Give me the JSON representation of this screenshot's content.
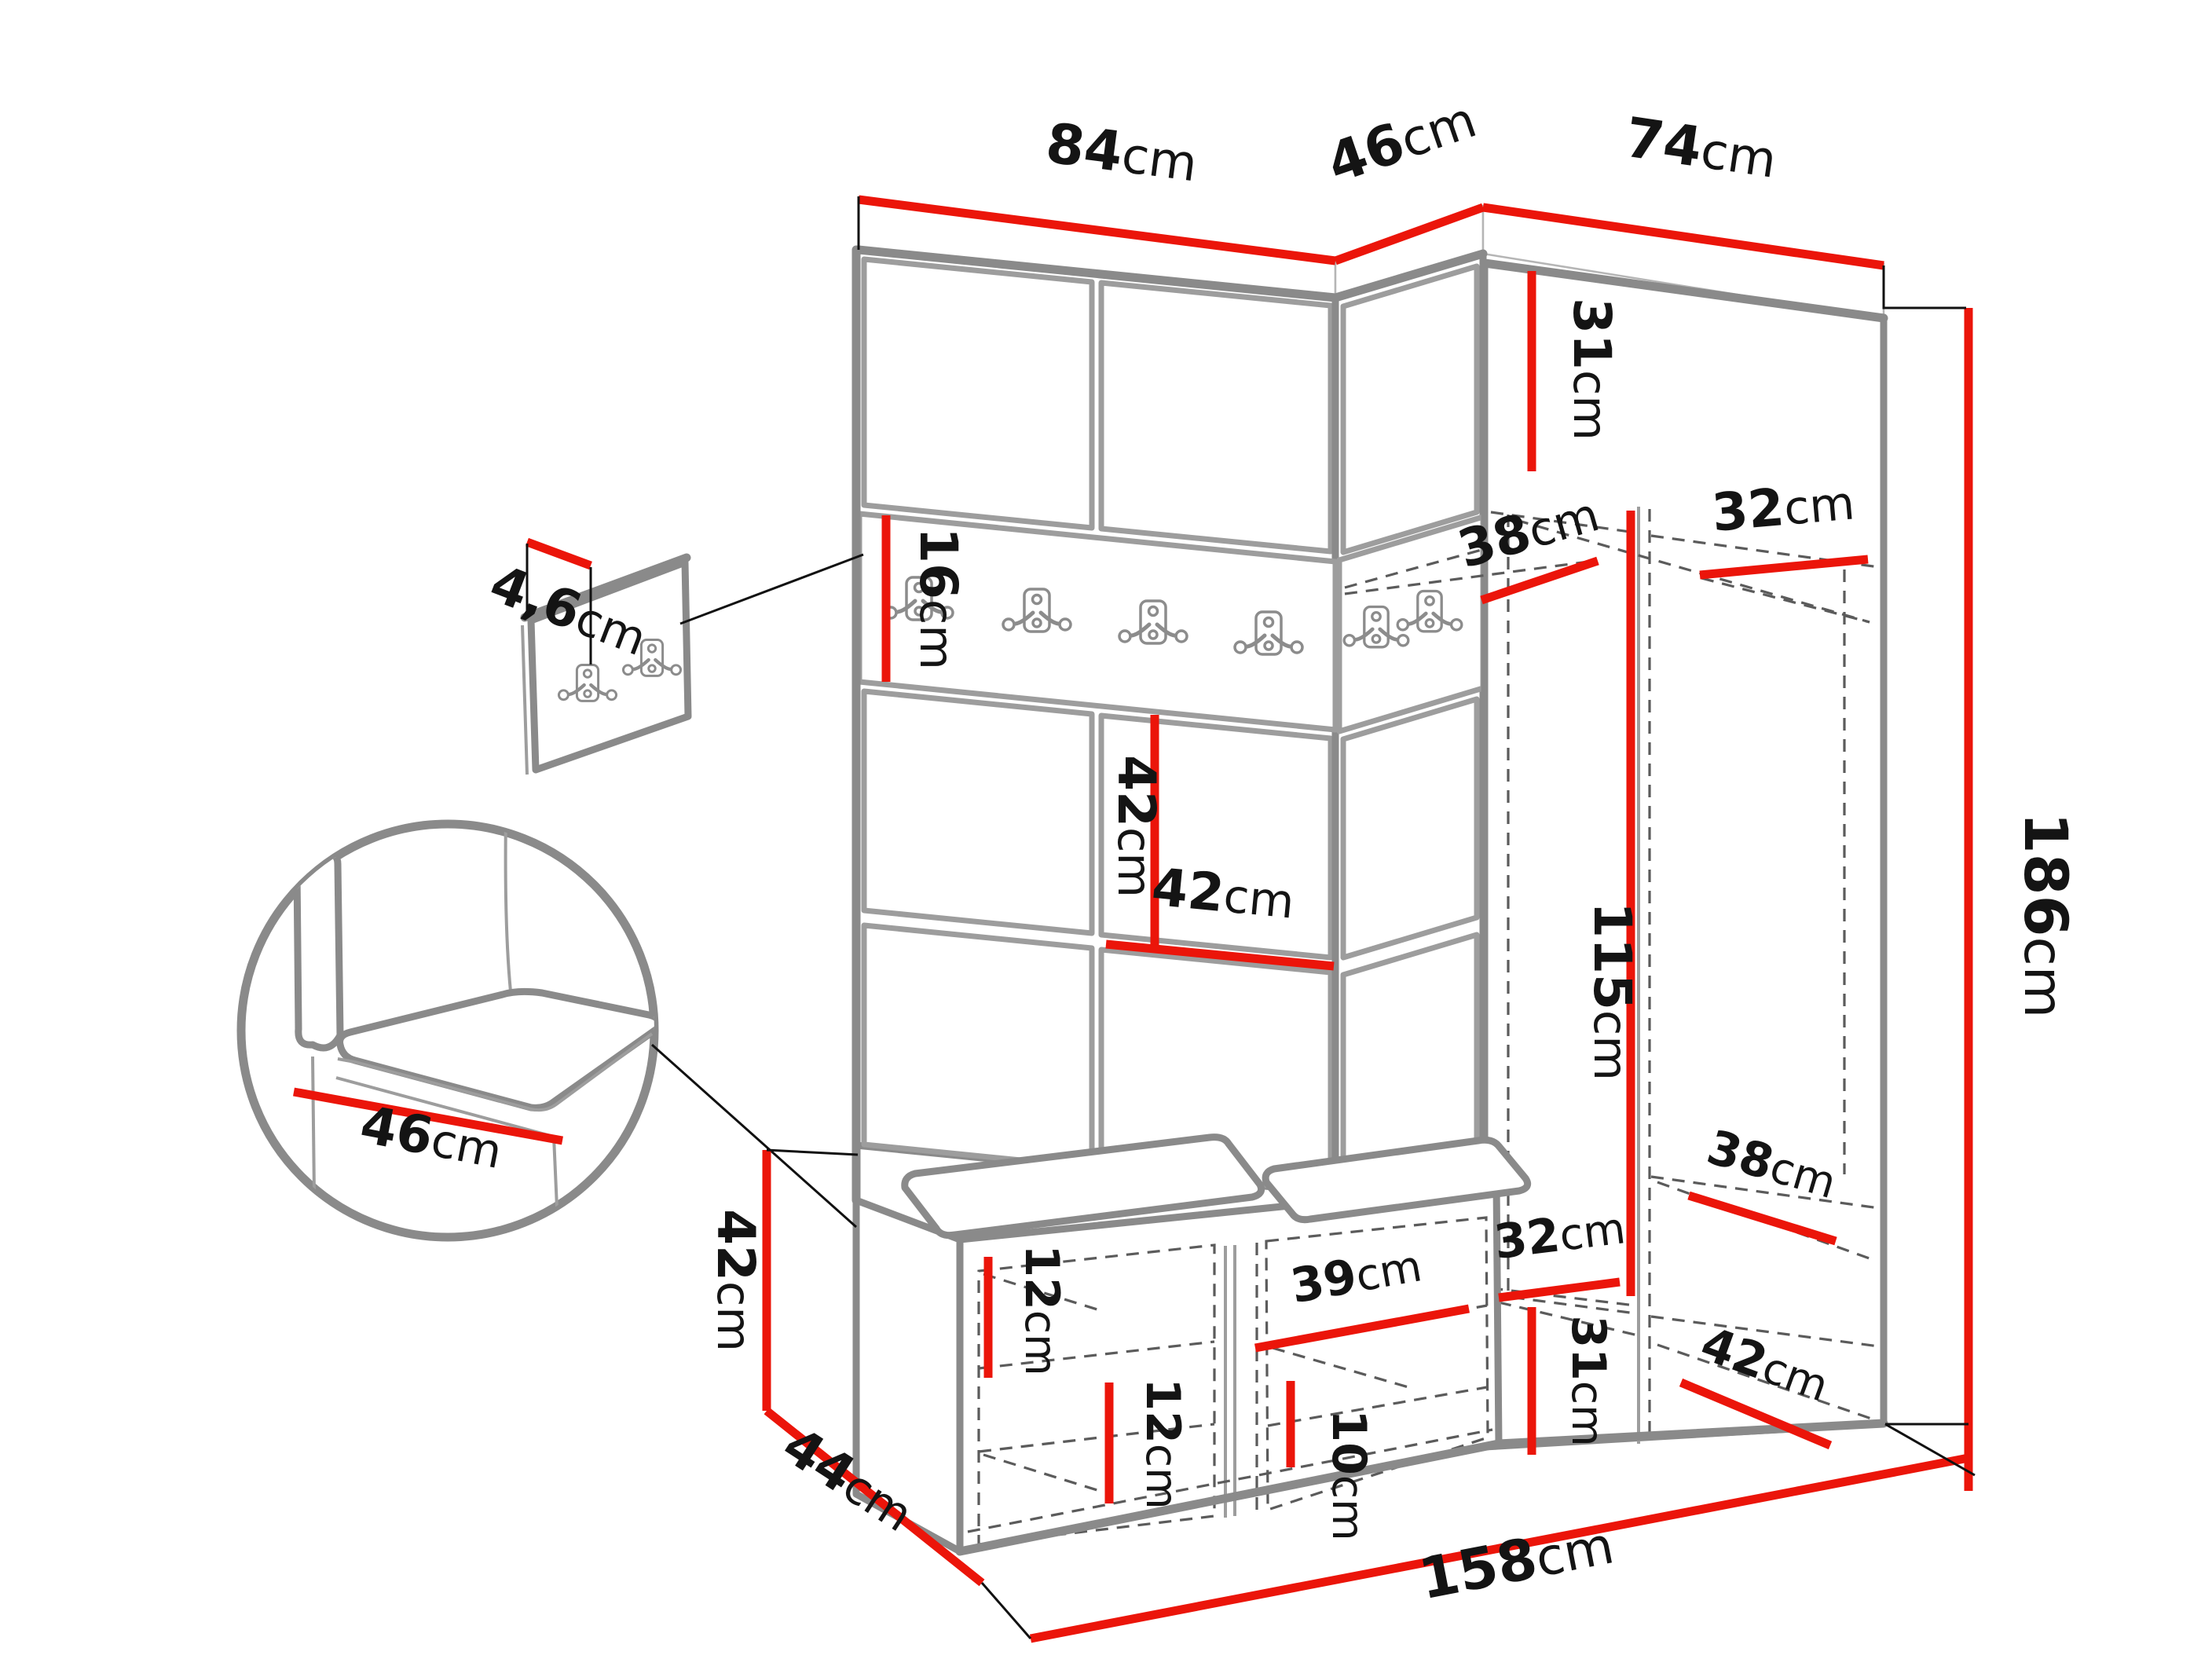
{
  "diagram": {
    "type": "furniture-dimension-diagram",
    "subject": "Hallway wardrobe set: upholstered wall panels with coat-hook rail, corner wardrobe, shoe bench with cushions, separate hook panel and seat detail",
    "colors": {
      "dimension_line": "#eb150a",
      "furniture_outline": "#8a8a8a",
      "hidden_line": "#5b5b5b",
      "label_text": "#141414",
      "background": "#ffffff"
    }
  },
  "dimensions": {
    "top_left_width": {
      "value": "84",
      "unit": "cm"
    },
    "corner_width": {
      "value": "46",
      "unit": "cm"
    },
    "right_width": {
      "value": "74",
      "unit": "cm"
    },
    "hook_panel_thickness": {
      "value": "4,6",
      "unit": "cm"
    },
    "hook_rail_height": {
      "value": "16",
      "unit": "cm"
    },
    "panel_height": {
      "value": "42",
      "unit": "cm"
    },
    "panel_width": {
      "value": "42",
      "unit": "cm"
    },
    "top_shelf_height": {
      "value": "31",
      "unit": "cm"
    },
    "top_shelf_depth": {
      "value": "38",
      "unit": "cm"
    },
    "side_shelf_depth": {
      "value": "32",
      "unit": "cm"
    },
    "hanging_height": {
      "value": "115",
      "unit": "cm"
    },
    "total_height": {
      "value": "186",
      "unit": "cm"
    },
    "seat_depth": {
      "value": "46",
      "unit": "cm"
    },
    "bench_height": {
      "value": "42",
      "unit": "cm"
    },
    "bench_depth": {
      "value": "44",
      "unit": "cm"
    },
    "total_width": {
      "value": "158",
      "unit": "cm"
    },
    "shoe_shelf_gap_left": {
      "value": "12",
      "unit": "cm"
    },
    "shoe_shelf_gap_mid": {
      "value": "12",
      "unit": "cm"
    },
    "shoe_compartment_width": {
      "value": "39",
      "unit": "cm"
    },
    "shoe_shelf_gap_right": {
      "value": "10",
      "unit": "cm"
    },
    "bottom_shelf_width": {
      "value": "32",
      "unit": "cm"
    },
    "bottom_shelf_height": {
      "value": "31",
      "unit": "cm"
    },
    "bottom_shelf_depth": {
      "value": "38",
      "unit": "cm"
    },
    "floor_shelf_depth": {
      "value": "42",
      "unit": "cm"
    }
  }
}
